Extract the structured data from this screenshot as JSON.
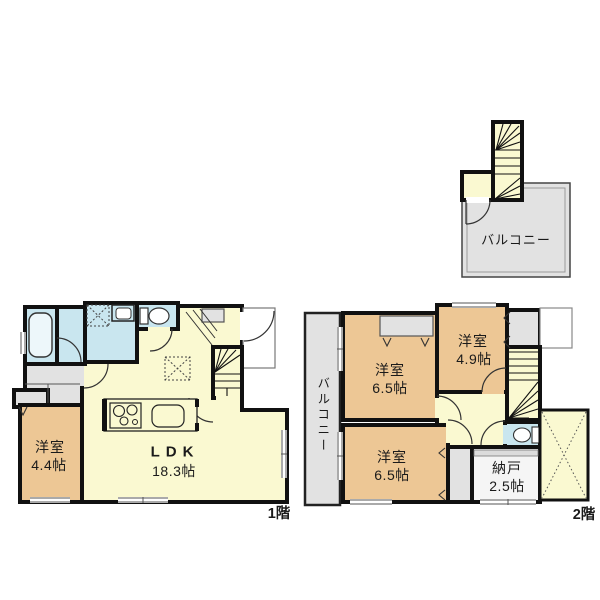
{
  "colors": {
    "wall": "#111111",
    "room_yellow": "#FAF9D1",
    "room_orange": "#EDC795",
    "room_blue": "#C9E6EF",
    "area_gray": "#E2E2E2",
    "storage_fill": "#F5F5F5",
    "tub_fill": "#EDF7FA",
    "white": "#FFFFFF"
  },
  "roof": {
    "balcony_label": "バルコニー"
  },
  "floor1": {
    "label": "1階",
    "bedroom": {
      "name": "洋室",
      "area": "4.4帖"
    },
    "ldk": {
      "name": "LDK",
      "area": "18.3帖"
    }
  },
  "floor2": {
    "label": "2階",
    "balcony_label": "バルコニー",
    "bedroom_top": {
      "name": "洋室",
      "area": "6.5帖"
    },
    "bedroom_right": {
      "name": "洋室",
      "area": "4.9帖"
    },
    "bedroom_bottom": {
      "name": "洋室",
      "area": "6.5帖"
    },
    "storage": {
      "name": "納戸",
      "area": "2.5帖"
    }
  }
}
